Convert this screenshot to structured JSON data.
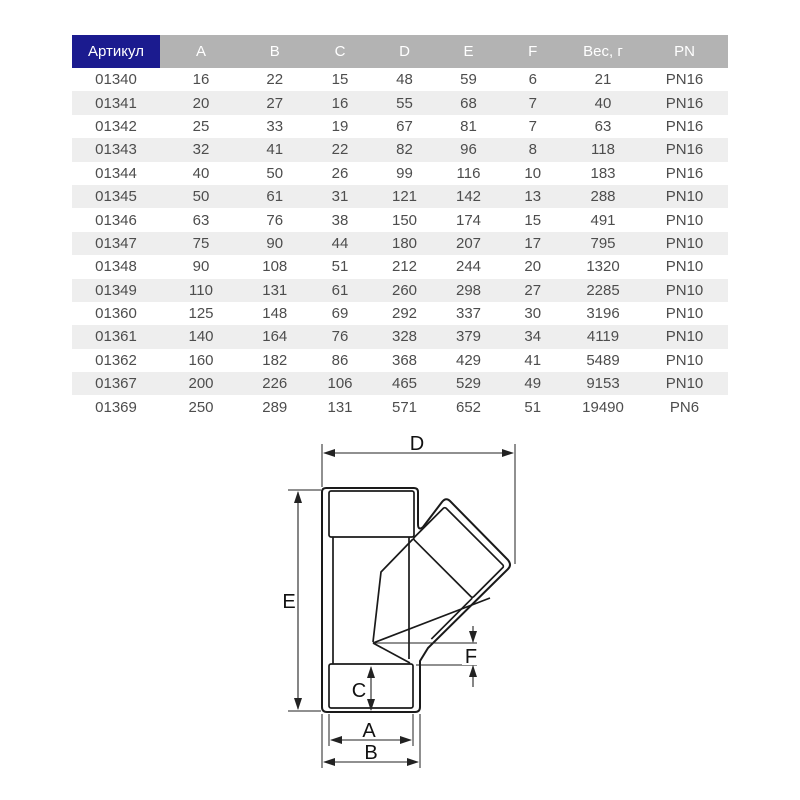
{
  "table": {
    "columns": [
      "Артикул",
      "A",
      "B",
      "C",
      "D",
      "E",
      "F",
      "Вес, г",
      "PN"
    ],
    "rows": [
      [
        "01340",
        "16",
        "22",
        "15",
        "48",
        "59",
        "6",
        "21",
        "PN16"
      ],
      [
        "01341",
        "20",
        "27",
        "16",
        "55",
        "68",
        "7",
        "40",
        "PN16"
      ],
      [
        "01342",
        "25",
        "33",
        "19",
        "67",
        "81",
        "7",
        "63",
        "PN16"
      ],
      [
        "01343",
        "32",
        "41",
        "22",
        "82",
        "96",
        "8",
        "118",
        "PN16"
      ],
      [
        "01344",
        "40",
        "50",
        "26",
        "99",
        "116",
        "10",
        "183",
        "PN16"
      ],
      [
        "01345",
        "50",
        "61",
        "31",
        "121",
        "142",
        "13",
        "288",
        "PN10"
      ],
      [
        "01346",
        "63",
        "76",
        "38",
        "150",
        "174",
        "15",
        "491",
        "PN10"
      ],
      [
        "01347",
        "75",
        "90",
        "44",
        "180",
        "207",
        "17",
        "795",
        "PN10"
      ],
      [
        "01348",
        "90",
        "108",
        "51",
        "212",
        "244",
        "20",
        "1320",
        "PN10"
      ],
      [
        "01349",
        "110",
        "131",
        "61",
        "260",
        "298",
        "27",
        "2285",
        "PN10"
      ],
      [
        "01360",
        "125",
        "148",
        "69",
        "292",
        "337",
        "30",
        "3196",
        "PN10"
      ],
      [
        "01361",
        "140",
        "164",
        "76",
        "328",
        "379",
        "34",
        "4119",
        "PN10"
      ],
      [
        "01362",
        "160",
        "182",
        "86",
        "368",
        "429",
        "41",
        "5489",
        "PN10"
      ],
      [
        "01367",
        "200",
        "226",
        "106",
        "465",
        "529",
        "49",
        "9153",
        "PN10"
      ],
      [
        "01369",
        "250",
        "289",
        "131",
        "571",
        "652",
        "51",
        "19490",
        "PN6"
      ]
    ],
    "colors": {
      "article_header_bg": "#1b1b8f",
      "header_bg": "#b3b3b3",
      "header_text": "#ffffff",
      "row_alt_bg": "#eeeeee",
      "cell_text": "#4d4d4d"
    }
  },
  "diagram": {
    "type": "45-degree wye fitting technical drawing",
    "labels": {
      "top_width": "D",
      "height": "E",
      "socket_depth": "C",
      "inner_width": "A",
      "outer_width": "B",
      "offset": "F"
    },
    "line_color": "#1a1a1a"
  }
}
